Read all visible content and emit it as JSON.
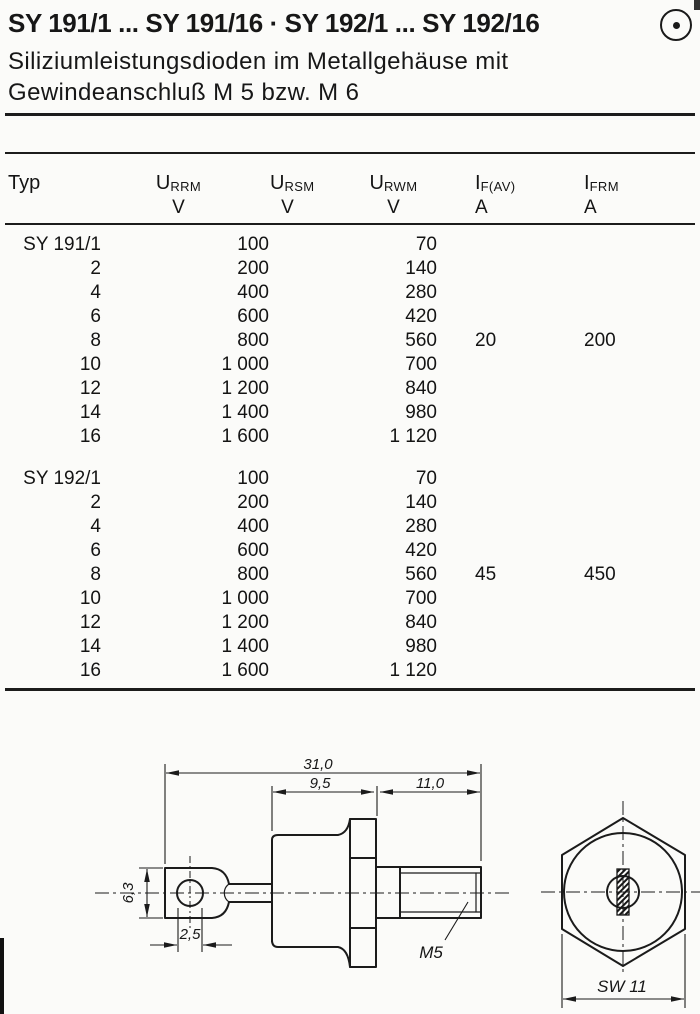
{
  "header": {
    "title": "SY 191/1 ... SY 191/16 · SY 192/1 ... SY 192/16",
    "subtitle_line1": "Siliziumleistungsdioden im Metallgehäuse mit",
    "subtitle_line2": "Gewindeanschluß M 5 bzw. M 6",
    "mark_icon": "circled-dot"
  },
  "table": {
    "col_typ": "Typ",
    "cols": [
      {
        "base": "U",
        "sub": "RRM",
        "unit": "V"
      },
      {
        "base": "U",
        "sub": "RSM",
        "unit": "V"
      },
      {
        "base": "U",
        "sub": "RWM",
        "unit": "V"
      },
      {
        "base": "I",
        "sub": "F(AV)",
        "unit": "A"
      },
      {
        "base": "I",
        "sub": "FRM",
        "unit": "A"
      }
    ],
    "groups": [
      {
        "if_av": "20",
        "i_frm": "200",
        "rows": [
          {
            "typ": "SY 191/1",
            "urrm": "100",
            "urwm": "70"
          },
          {
            "typ": "2",
            "urrm": "200",
            "urwm": "140"
          },
          {
            "typ": "4",
            "urrm": "400",
            "urwm": "280"
          },
          {
            "typ": "6",
            "urrm": "600",
            "urwm": "420"
          },
          {
            "typ": "8",
            "urrm": "800",
            "urwm": "560"
          },
          {
            "typ": "10",
            "urrm": "1 000",
            "urwm": "700"
          },
          {
            "typ": "12",
            "urrm": "1 200",
            "urwm": "840"
          },
          {
            "typ": "14",
            "urrm": "1 400",
            "urwm": "980"
          },
          {
            "typ": "16",
            "urrm": "1 600",
            "urwm": "1 120"
          }
        ]
      },
      {
        "if_av": "45",
        "i_frm": "450",
        "rows": [
          {
            "typ": "SY 192/1",
            "urrm": "100",
            "urwm": "70"
          },
          {
            "typ": "2",
            "urrm": "200",
            "urwm": "140"
          },
          {
            "typ": "4",
            "urrm": "400",
            "urwm": "280"
          },
          {
            "typ": "6",
            "urrm": "600",
            "urwm": "420"
          },
          {
            "typ": "8",
            "urrm": "800",
            "urwm": "560"
          },
          {
            "typ": "10",
            "urrm": "1 000",
            "urwm": "700"
          },
          {
            "typ": "12",
            "urrm": "1 200",
            "urwm": "840"
          },
          {
            "typ": "14",
            "urrm": "1 400",
            "urwm": "980"
          },
          {
            "typ": "16",
            "urrm": "1 600",
            "urwm": "1 120"
          }
        ]
      }
    ]
  },
  "drawing": {
    "dim_overall": "31,0",
    "dim_body": "9,5",
    "dim_stud": "11,0",
    "dim_lug_height": "6,3",
    "dim_hole": "2,5",
    "thread_label": "M5",
    "wrench_label": "SW 11"
  }
}
